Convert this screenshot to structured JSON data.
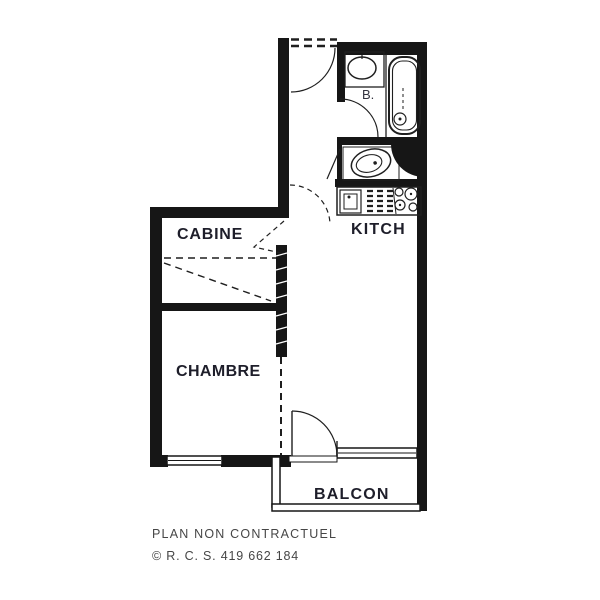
{
  "plan": {
    "wall_color": "#161616",
    "label_color": "#1e1e2a",
    "background": "#ffffff",
    "rooms": {
      "cabine": "CABINE",
      "kitchen": "KITCH",
      "chambre": "CHAMBRE",
      "balcon": "BALCON",
      "bath": "B."
    },
    "fixtures": [
      {
        "name": "washbasin-icon"
      },
      {
        "name": "bathtub-icon"
      },
      {
        "name": "toilet-icon"
      },
      {
        "name": "kitchen-sink-icon"
      },
      {
        "name": "stove-burners-icon"
      },
      {
        "name": "bunk-bed-marks"
      },
      {
        "name": "door-swing-arcs"
      },
      {
        "name": "windows"
      }
    ]
  },
  "footer": {
    "line1": "PLAN NON CONTRACTUEL",
    "line2": "© R. C. S. 419 662 184"
  }
}
